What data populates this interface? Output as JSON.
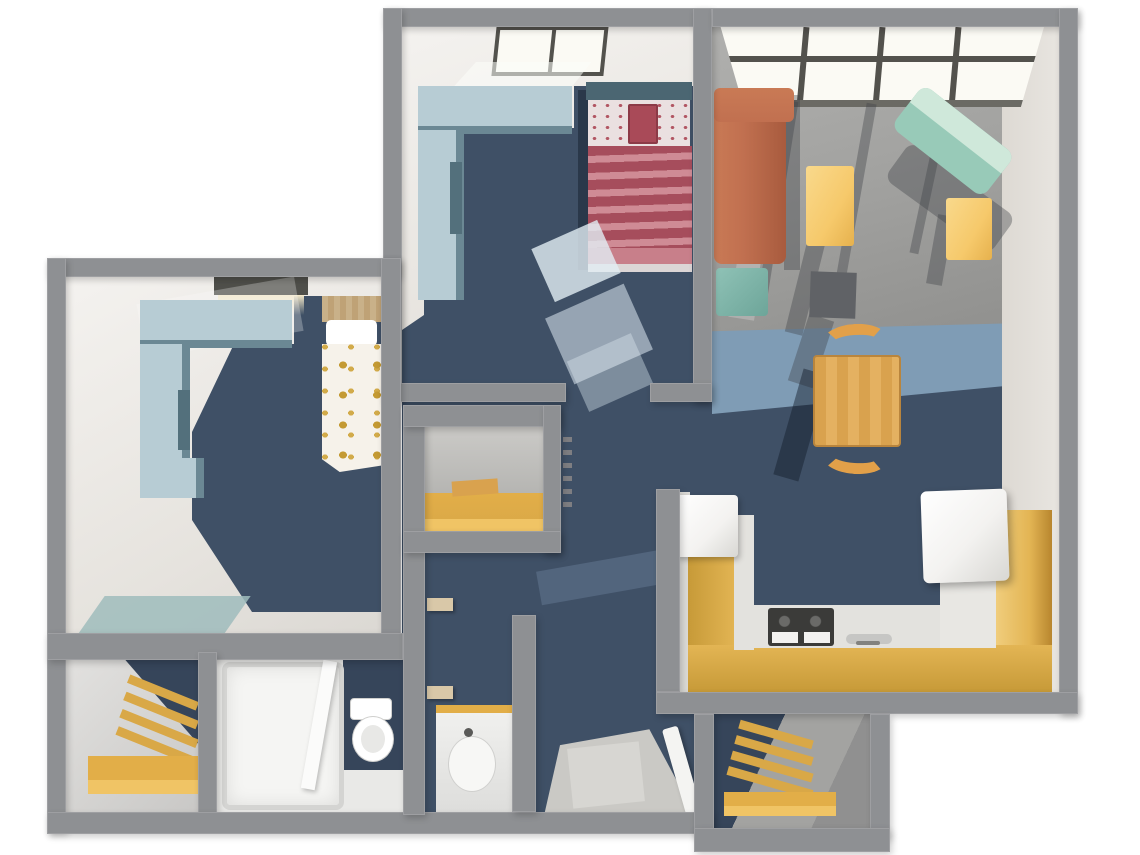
{
  "meta": {
    "title": "3D rendered apartment floor plan, top-down view",
    "type": "floor-plan-render",
    "view": "overhead 3D dollhouse"
  },
  "palette": {
    "wall": "#8e9093",
    "floorA1": "#f4f2ef",
    "floorA2": "#e6e3de",
    "navy": "#3f5066",
    "navyDark": "#36455a",
    "blueBand": "#7f9cb5",
    "grayFloor": "#a3a3a1",
    "cream": "#e8e5e0",
    "glass": "#fbfaf4",
    "frame": "#53524d",
    "sill": "#6b6a64",
    "deskTop": "#b7ccd4",
    "deskSide": "#6b8894",
    "deskDark": "#53707c",
    "tealHead": "#4b6672",
    "stripeD": "#a64d5c",
    "stripeL": "#cf8b95",
    "floralBg": "#eae0e0",
    "floralDot": "#b25663",
    "cushion": "#a94a58",
    "cushionEdge": "#8c3a47",
    "foldPink": "#c87f8a",
    "sheet": "#dcd6d6",
    "woodHead1": "#c9b189",
    "woodHead2": "#bfa276",
    "duvet": "#f6f2ea",
    "dotGold": "#c49a33",
    "sofa": "#c17050",
    "sofaDark": "#a85b3e",
    "sofaLight": "#c97a55",
    "ottoman1": "#8fc2b6",
    "ottoman2": "#6da599",
    "tealSeat": "#98cab8",
    "tealSeatL": "#cfe8da",
    "tableY": "#f6c96b",
    "tableY1": "#f9d98c",
    "tableY2": "#e6b14d",
    "wood1": "#d9a24e",
    "wood2": "#e4b161",
    "woodEdge": "#b9853d",
    "chair": "#e2a049",
    "gold1": "#c79a38",
    "gold2": "#e3b554",
    "goldL": "#f0cd7c",
    "counterTop": "#e3e2de",
    "appliance": "#f3f2f0",
    "stove": "#3b3b39",
    "burner": "#6a6a68",
    "sinkSteel": "#c6c6c4",
    "shelfG1": "#d9a847",
    "shelfG2": "#e2ae48",
    "shelfG3": "#f0c465",
    "bath": "#e9e9e7",
    "shower": "#f5f5f3",
    "showerRim": "#d4d4d2",
    "fixture": "#ffffff",
    "fixtureEdge": "#d0d0ce",
    "entry": "#cac9c5",
    "mat": "#d8d7d3",
    "rugTeal": "#9fbcbc",
    "lightPool": "rgba(252,253,250,0.55)",
    "shadowC": "rgba(62,66,72,0.38)",
    "shadowN": "rgba(18,26,40,0.45)",
    "sun": "rgba(255,255,255,0.22)",
    "tan": "#d9c8a8",
    "medGray": "#606266",
    "sliver": "#dcdbd7",
    "lintel": "#4f4f4a",
    "glow": "#f2e7c8",
    "dash": "#7e7e82",
    "grayStreak": "rgba(140,165,195,0.25)"
  },
  "rooms": [
    {
      "name": "bedroom-1",
      "position": "top-center",
      "floor": "navy carpet",
      "furniture": [
        "window",
        "corner desk unit",
        "bed with red striped duvet",
        "light area rugs"
      ]
    },
    {
      "name": "living-room",
      "position": "top-right",
      "floor": "gray carpet, blue carpet band, navy carpet",
      "furniture": [
        "window wall",
        "orange sofa",
        "teal ottoman",
        "yellow coffee table",
        "teal loveseat",
        "yellow side table",
        "media stand",
        "wood dining table",
        "two bentwood chairs"
      ]
    },
    {
      "name": "bedroom-2",
      "position": "left",
      "floor": "navy carpet",
      "furniture": [
        "window",
        "corner desk unit",
        "bed with gold polka-dot duvet",
        "teal rug"
      ]
    },
    {
      "name": "walk-in-closet",
      "position": "center",
      "furniture": [
        "gold shelf"
      ]
    },
    {
      "name": "closet",
      "position": "bottom-left",
      "furniture": [
        "gold shelving unit"
      ]
    },
    {
      "name": "bathroom",
      "position": "bottom",
      "furniture": [
        "shower",
        "toilet"
      ]
    },
    {
      "name": "vanity-nook",
      "position": "bottom-center",
      "furniture": [
        "vanity sink cabinet",
        "wall shelves"
      ]
    },
    {
      "name": "kitchen",
      "position": "right",
      "furniture": [
        "u-shaped gold counter",
        "refrigerator",
        "range",
        "sink",
        "white appliance"
      ]
    },
    {
      "name": "entry",
      "position": "bottom-center",
      "furniture": [
        "floor mat",
        "open door leaf"
      ]
    },
    {
      "name": "storage-closet",
      "position": "bottom-right",
      "furniture": [
        "gold shelving unit"
      ]
    }
  ]
}
